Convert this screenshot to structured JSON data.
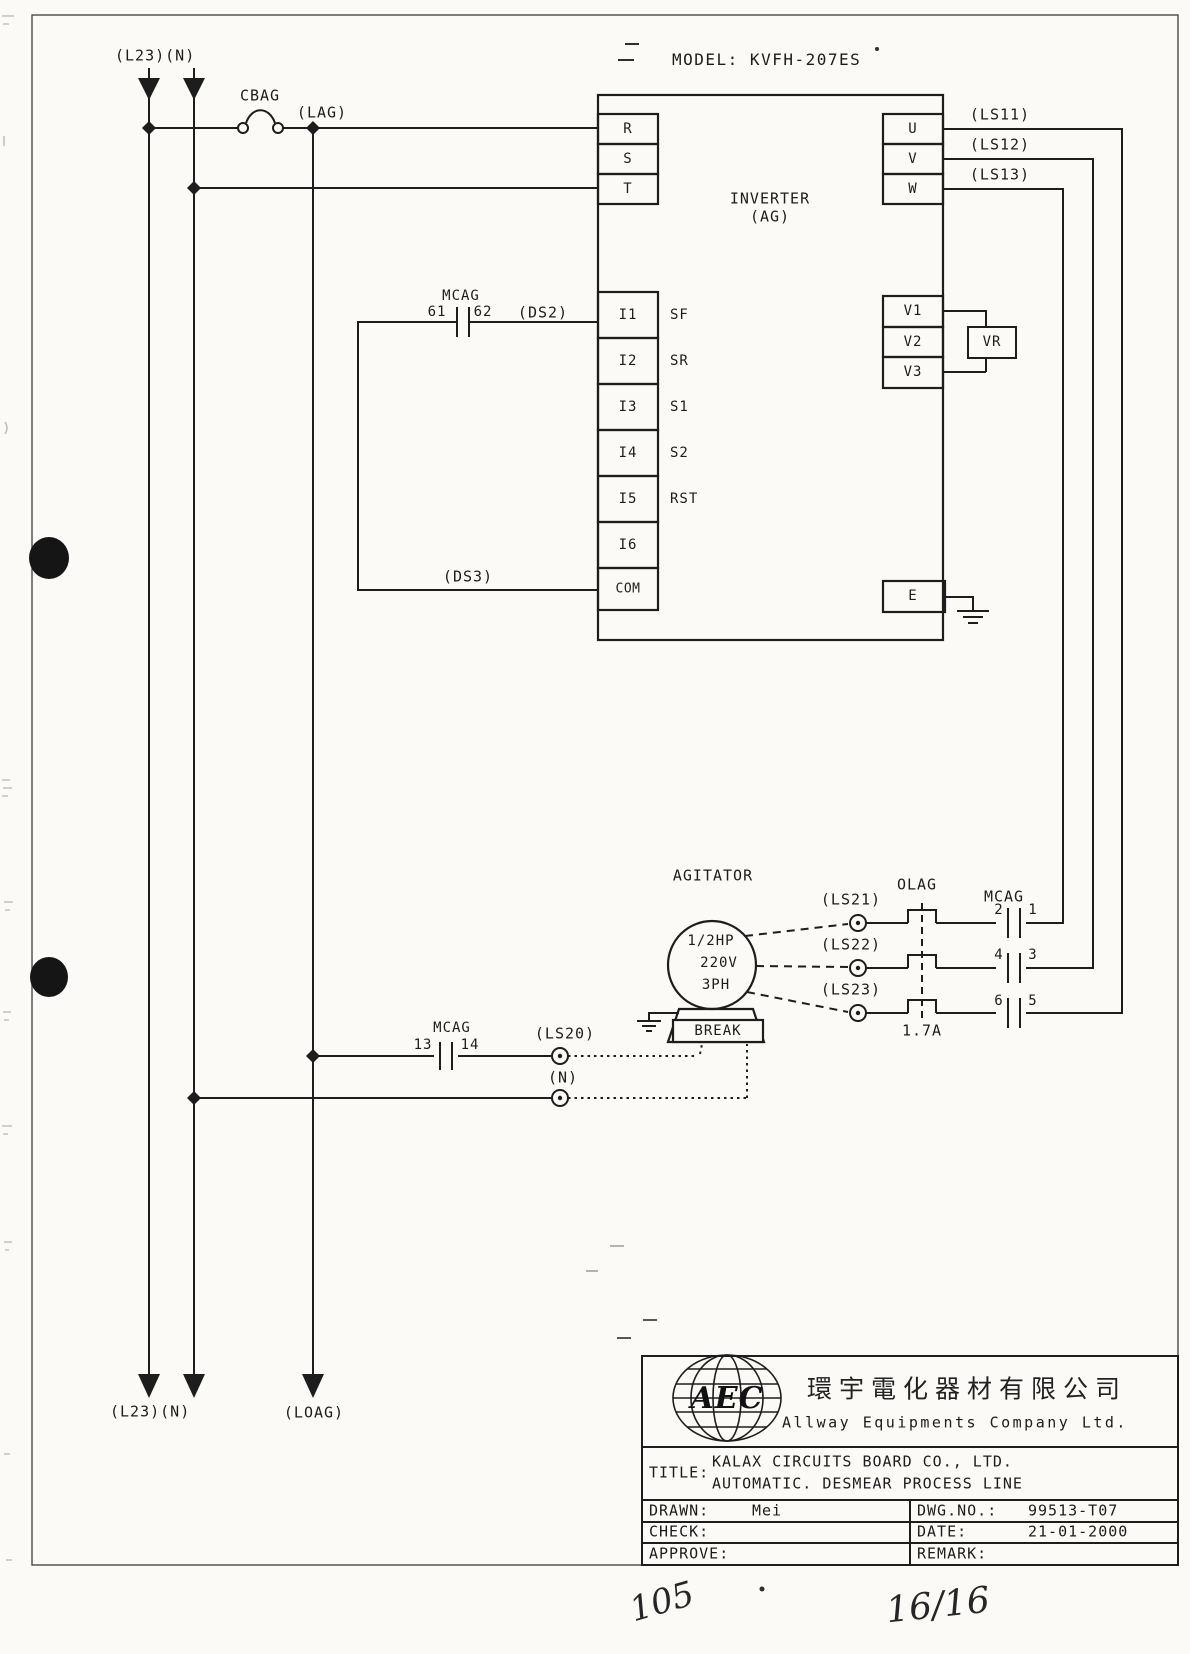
{
  "page": {
    "handwritten_page_number": "105",
    "handwritten_sheet_number": "16/16"
  },
  "feeds": {
    "top_label": "(L23)(N)",
    "fuse_label": "CBAG",
    "lag_label": "(LAG)",
    "bottom_left_label": "(L23)(N)",
    "bottom_load_label": "(LOAG)"
  },
  "inverter": {
    "model_label": "MODEL: KVFH-207ES",
    "name": "INVERTER",
    "name_sub": "(AG)",
    "power_in": [
      {
        "label": "R"
      },
      {
        "label": "S"
      },
      {
        "label": "T"
      }
    ],
    "power_out": [
      {
        "label": "U",
        "wire_label": "(LS11)"
      },
      {
        "label": "V",
        "wire_label": "(LS12)"
      },
      {
        "label": "W",
        "wire_label": "(LS13)"
      }
    ],
    "control_in": [
      {
        "label": "I1",
        "signal": "SF"
      },
      {
        "label": "I2",
        "signal": "SR"
      },
      {
        "label": "I3",
        "signal": "S1"
      },
      {
        "label": "I4",
        "signal": "S2"
      },
      {
        "label": "I5",
        "signal": "RST"
      },
      {
        "label": "I6",
        "signal": ""
      },
      {
        "label": "COM",
        "signal": ""
      }
    ],
    "analog_terminals": [
      {
        "label": "V1"
      },
      {
        "label": "V2"
      },
      {
        "label": "V3"
      }
    ],
    "vr_label": "VR",
    "earth_label": "E"
  },
  "ds_branch": {
    "contactor_label": "MCAG",
    "terminal_left": "61",
    "terminal_right": "62",
    "ds2_label": "(DS2)",
    "ds3_label": "(DS3)"
  },
  "motor": {
    "title": "AGITATOR",
    "rating_hp": "1/2HP",
    "rating_volt": "220V",
    "rating_phase": "3PH",
    "brake_label": "BREAK"
  },
  "motor_circuit": {
    "olag_label": "OLAG",
    "mcag_label": "MCAG",
    "overload_rating": "1.7A",
    "rows": [
      {
        "ls_label": "(LS21)",
        "contact_left": "2",
        "contact_right": "1"
      },
      {
        "ls_label": "(LS22)",
        "contact_left": "4",
        "contact_right": "3"
      },
      {
        "ls_label": "(LS23)",
        "contact_left": "6",
        "contact_right": "5"
      }
    ]
  },
  "aux_branch": {
    "mcag_label": "MCAG",
    "terminal_left": "13",
    "terminal_right": "14",
    "ls20_label": "(LS20)",
    "n_label": "(N)"
  },
  "title_block": {
    "logo_text": "AEC",
    "company_cn": "環宇電化器材有限公司",
    "company_en": "Allway Equipments Company Ltd.",
    "title_label": "TITLE:",
    "title_line1": "KALAX CIRCUITS BOARD CO., LTD.",
    "title_line2": "AUTOMATIC. DESMEAR PROCESS LINE",
    "drawn_label": "DRAWN:",
    "drawn_value": "Mei",
    "dwg_label": "DWG.NO.:",
    "dwg_value": "99513-T07",
    "check_label": "CHECK:",
    "date_label": "DATE:",
    "date_value": "21-01-2000",
    "approve_label": "APPROVE:",
    "remark_label": "REMARK:"
  }
}
